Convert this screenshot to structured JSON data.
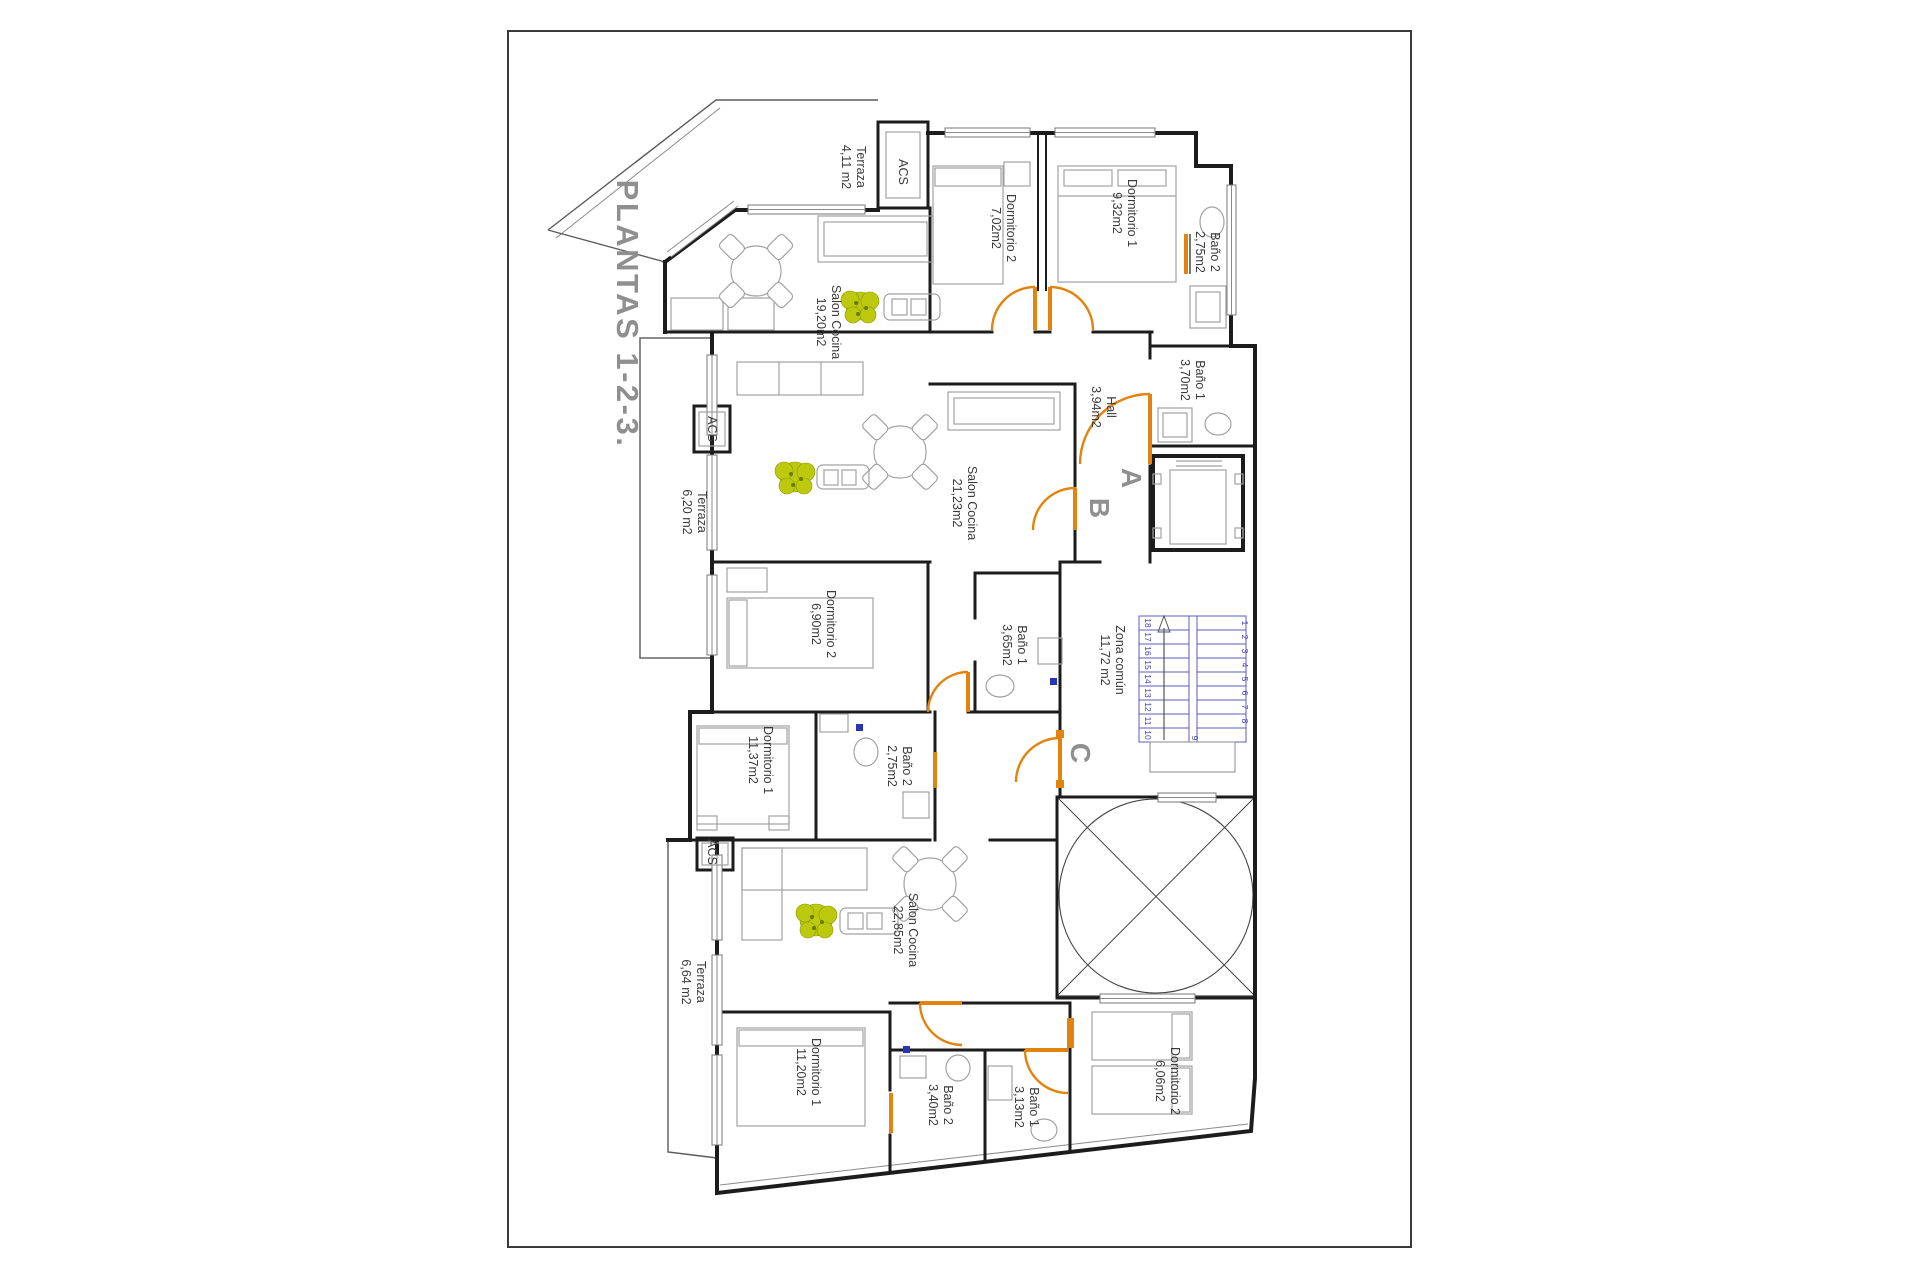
{
  "title": "PLANTAS 1-2-3.",
  "cores": {
    "a": "A",
    "b": "B",
    "c": "C"
  },
  "rooms": [
    {
      "name": "Terraza",
      "area": "4,11 m2"
    },
    {
      "name": "ACS",
      "area": ""
    },
    {
      "name": "Dormitorio 2",
      "area": "7,02m2"
    },
    {
      "name": "Dormitorio 1",
      "area": "9,32m2"
    },
    {
      "name": "Baño 2",
      "area": "2,75m2"
    },
    {
      "name": "Baño 1",
      "area": "3,70m2"
    },
    {
      "name": "Hall",
      "area": "3,94m2"
    },
    {
      "name": "Salon Cocina",
      "area": "19,20m2"
    },
    {
      "name": "Salon Cocina",
      "area": "21,23m2"
    },
    {
      "name": "Terraza",
      "area": "6,20 m2"
    },
    {
      "name": "ACS",
      "area": ""
    },
    {
      "name": "Dormitorio 2",
      "area": "6,90m2"
    },
    {
      "name": "Baño 1",
      "area": "3,65m2"
    },
    {
      "name": "Zona común",
      "area": "11,72 m2"
    },
    {
      "name": "Dormitorio 1",
      "area": "11,37m2"
    },
    {
      "name": "Baño 2",
      "area": "2,75m2"
    },
    {
      "name": "ACS",
      "area": ""
    },
    {
      "name": "Salon Cocina",
      "area": "22,85m2"
    },
    {
      "name": "Terraza",
      "area": "6,64 m2"
    },
    {
      "name": "Dormitorio 1",
      "area": "11,20m2"
    },
    {
      "name": "Baño 2",
      "area": "3,40m2"
    },
    {
      "name": "Baño 1",
      "area": "3,13m2"
    },
    {
      "name": "Dormitorio 2",
      "area": "6,06m2"
    }
  ],
  "stairs": {
    "numbers": [
      "1",
      "2",
      "3",
      "4",
      "5",
      "6",
      "7",
      "8",
      "9",
      "10",
      "11",
      "12",
      "13",
      "14",
      "15",
      "16",
      "17",
      "18"
    ]
  },
  "colors": {
    "wall": "#1c1c1c",
    "door_orange": "#e2830e",
    "stair_blue": "#5b5bbd",
    "title_gray": "#8f8f8f",
    "label_text": "#3b3b3b",
    "plant_green": "#bdc90e",
    "marker_blue": "#2a35b5"
  }
}
